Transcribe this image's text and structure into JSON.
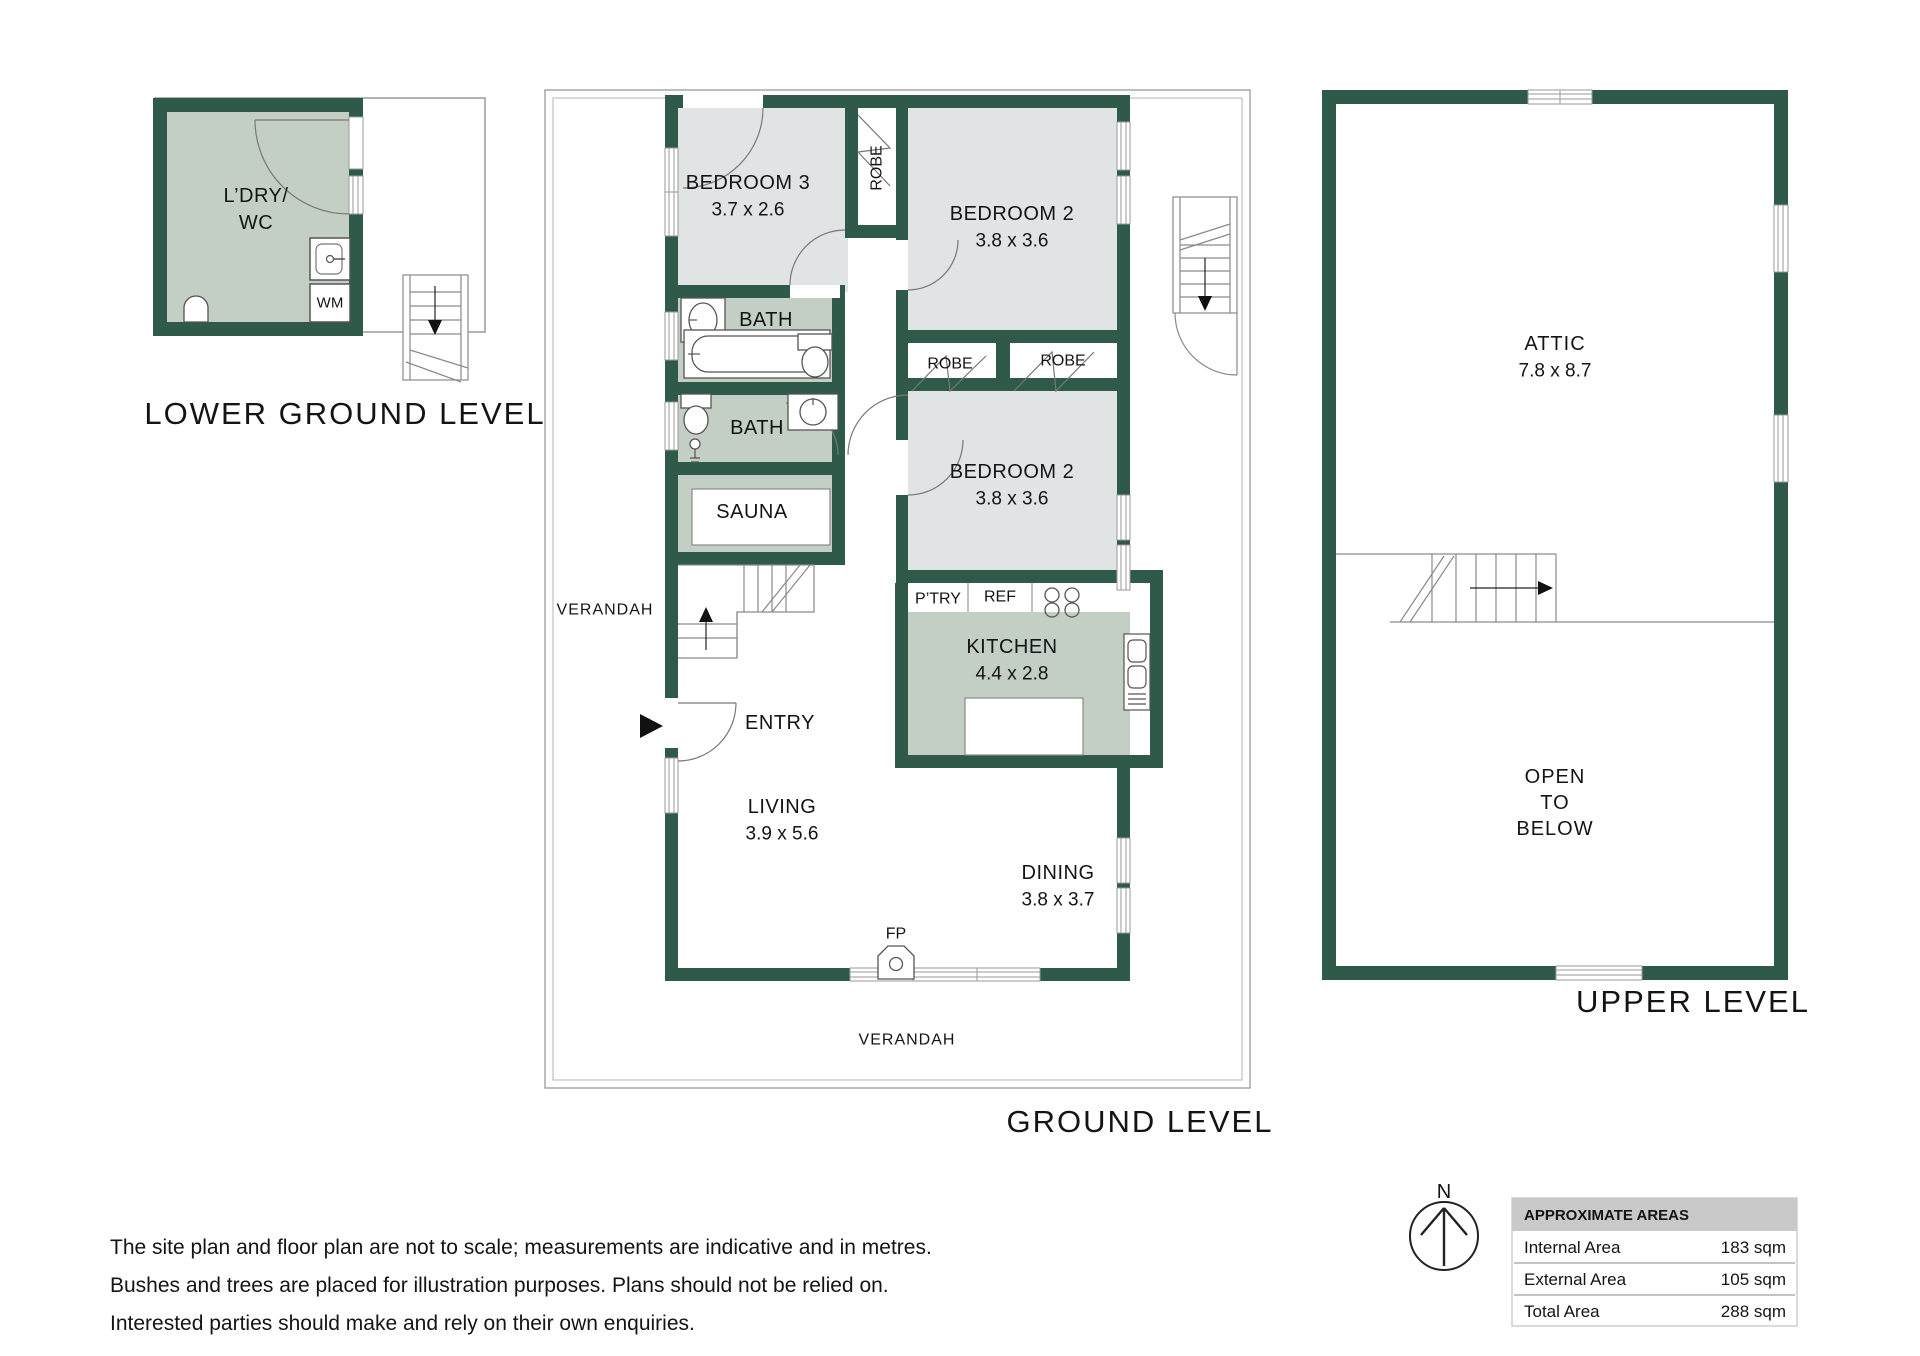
{
  "levels": {
    "lower": {
      "title": "LOWER GROUND LEVEL",
      "laundry_line1": "L’DRY/",
      "laundry_line2": "WC",
      "wm": "WM"
    },
    "ground": {
      "title": "GROUND LEVEL",
      "verandah_left": "VERANDAH",
      "verandah_bottom": "VERANDAH",
      "bedroom3": "BEDROOM 3",
      "bedroom3_dim": "3.7 x 2.6",
      "robe_vertical": "ROBE",
      "bedroom2_top": "BEDROOM 2",
      "bedroom2_top_dim": "3.8 x 3.6",
      "robe_mid": "ROBE",
      "robe_right": "ROBE",
      "bedroom2_mid": "BEDROOM 2",
      "bedroom2_mid_dim": "3.8 x 3.6",
      "bath_upper": "BATH",
      "bath_lower": "BATH",
      "sauna": "SAUNA",
      "pantry": "P’TRY",
      "fridge": "REF",
      "kitchen": "KITCHEN",
      "kitchen_dim": "4.4 x 2.8",
      "entry": "ENTRY",
      "living": "LIVING",
      "living_dim": "3.9 x 5.6",
      "dining": "DINING",
      "dining_dim": "3.8 x 3.7",
      "fireplace": "FP"
    },
    "upper": {
      "title": "UPPER LEVEL",
      "attic": "ATTIC",
      "attic_dim": "7.8 x 8.7",
      "open_line1": "OPEN",
      "open_line2": "TO",
      "open_line3": "BELOW"
    }
  },
  "compass": {
    "north": "N"
  },
  "areas_table": {
    "header": "APPROXIMATE AREAS",
    "rows": [
      {
        "label": "Internal Area",
        "value": "183 sqm"
      },
      {
        "label": "External Area",
        "value": "105 sqm"
      },
      {
        "label": "Total Area",
        "value": "288 sqm"
      }
    ]
  },
  "disclaimer": {
    "lines": [
      "The site plan and floor plan are not to scale; measurements are indicative and in metres.",
      "Bushes and trees are placed for illustration purposes. Plans should not be relied on.",
      "Interested parties should make and rely on their own enquiries."
    ]
  },
  "colors": {
    "wall": "#2F5A49",
    "bedroom_fill": "#E1E4E5",
    "wet_fill": "#C3CFC4",
    "outline": "#9A9A9A",
    "table_header_bg": "#C9C9C9"
  }
}
